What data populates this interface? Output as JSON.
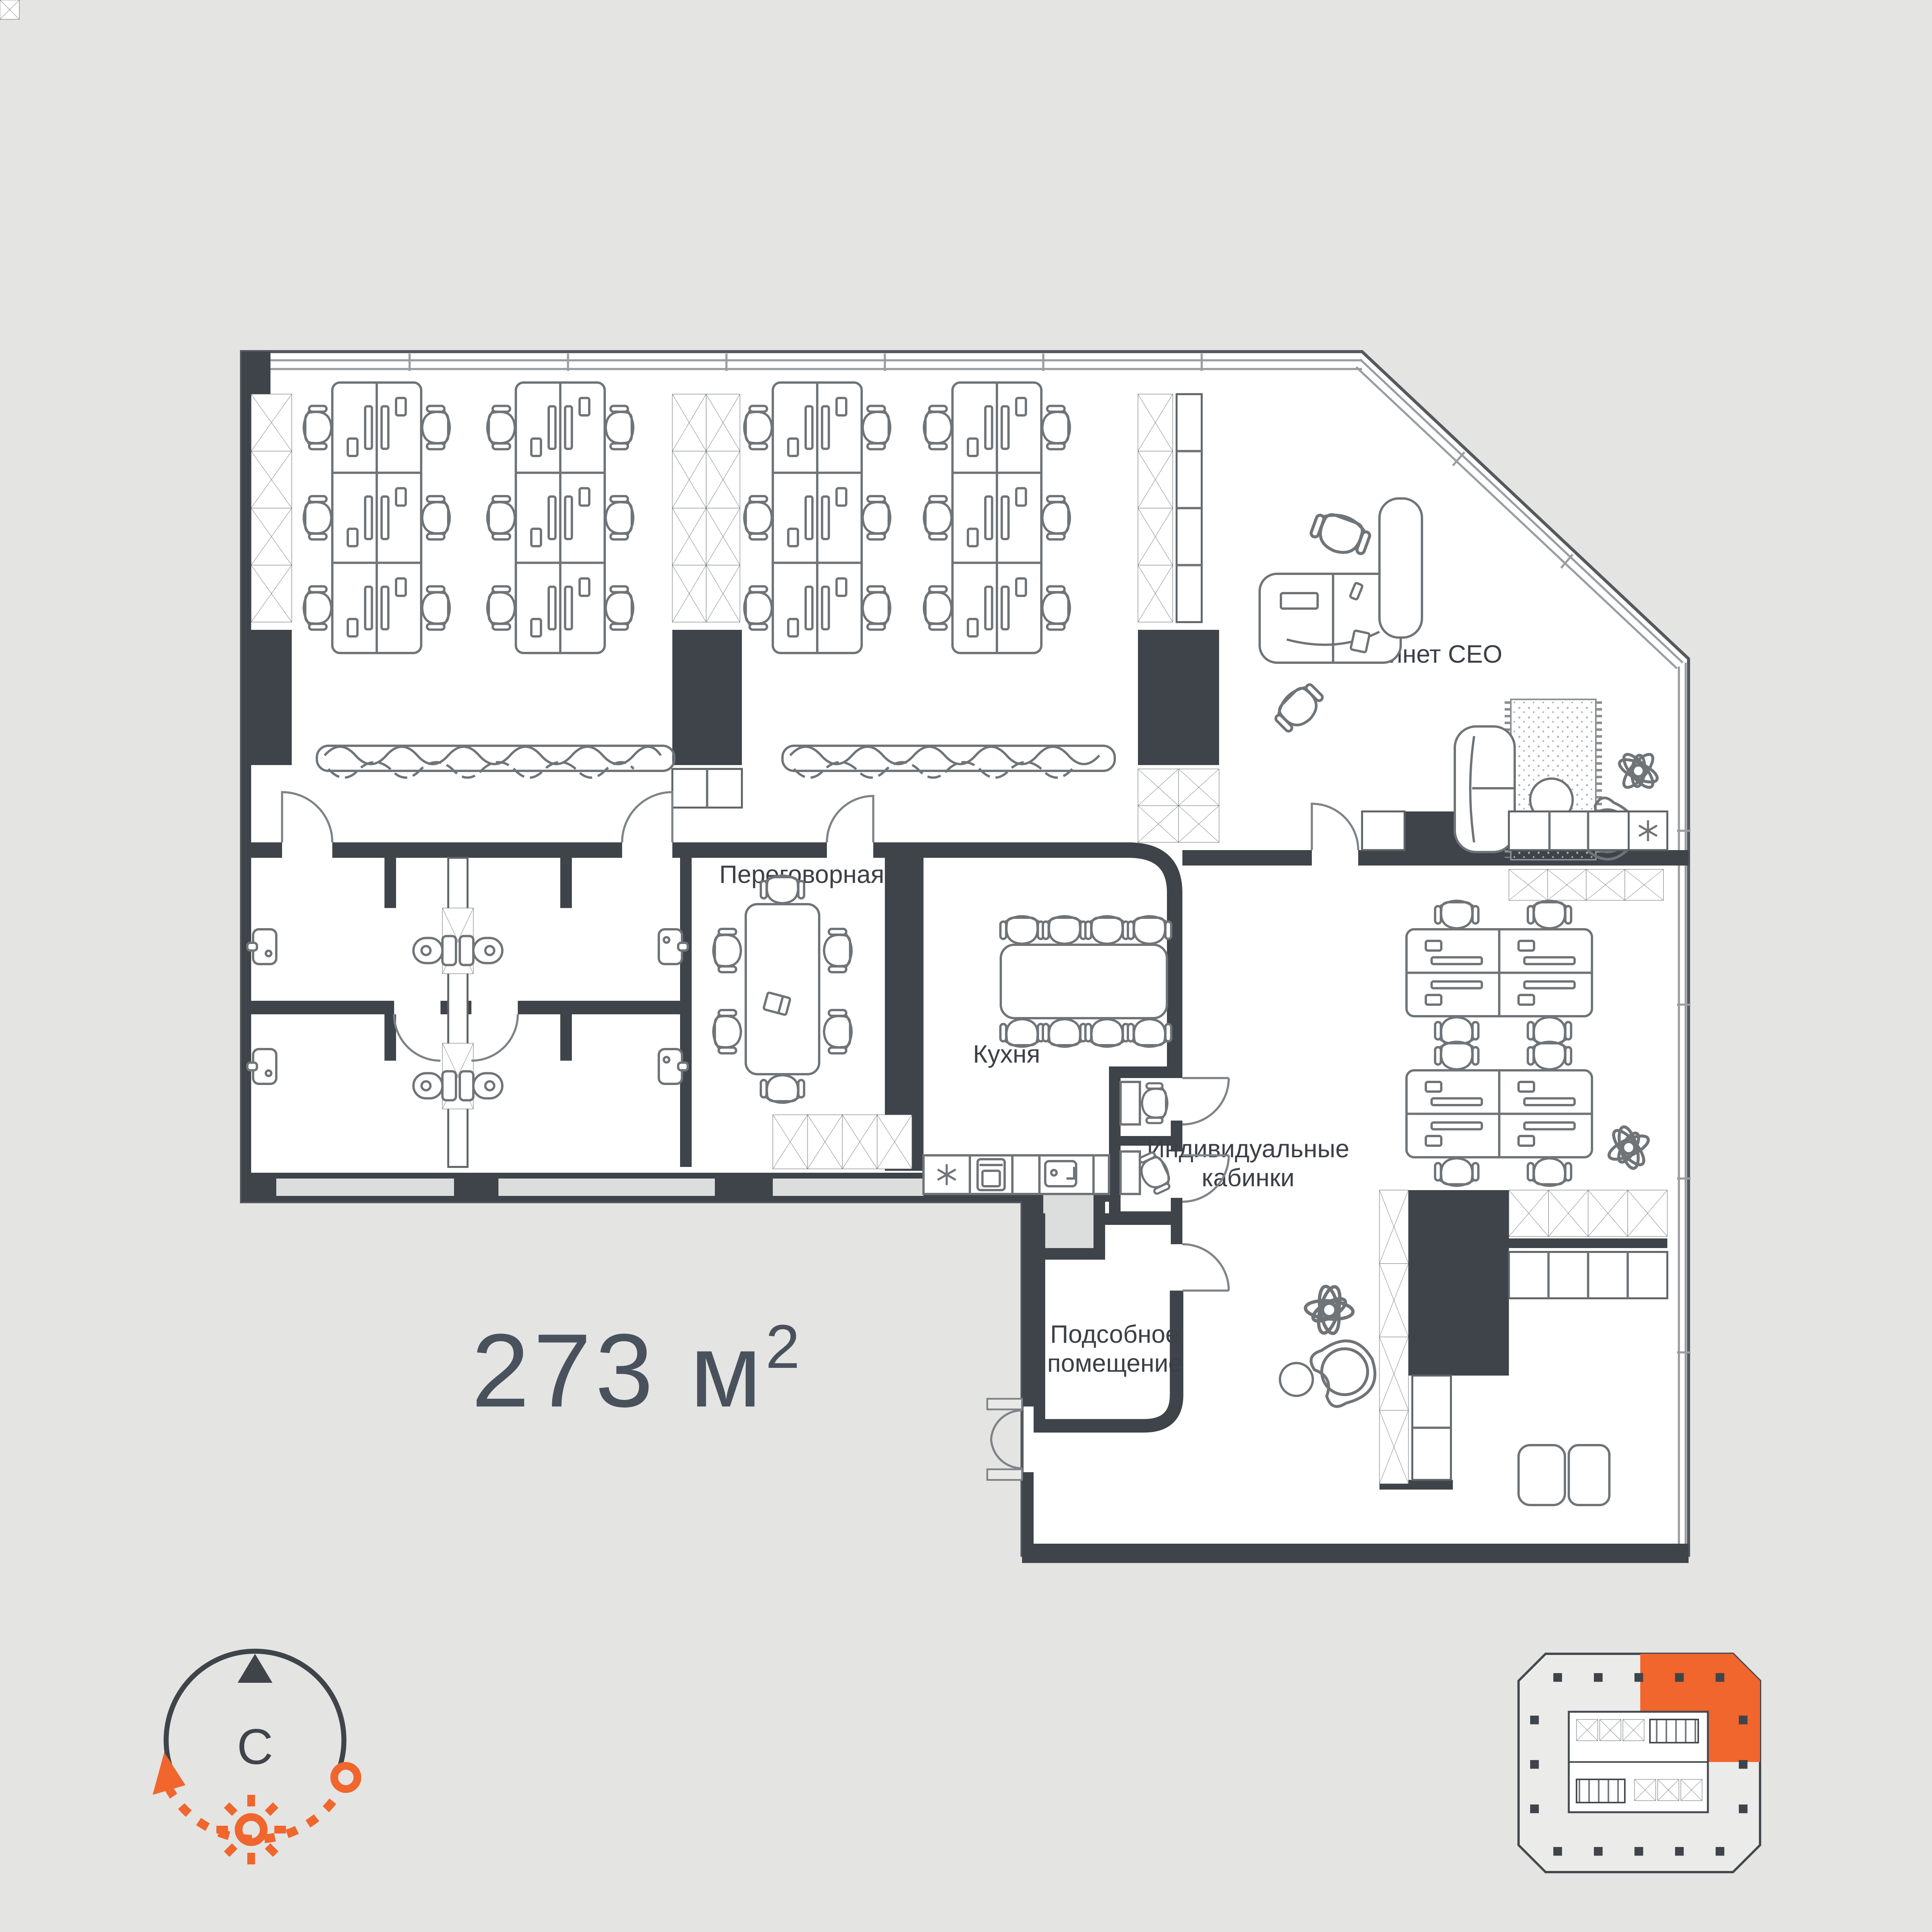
{
  "page": {
    "background": "#e4e4e3"
  },
  "floor_plan": {
    "area": {
      "value": "273",
      "unit_base": " м",
      "unit_sup": "2"
    },
    "room_labels": {
      "ceo_office": "Кабинет CEO",
      "meeting_room": "Переговорная",
      "kitchen": "Кухня",
      "individual_booths": [
        "Индивидуальные",
        "кабинки"
      ],
      "utility_room": [
        "Подсобное",
        "помещение"
      ]
    },
    "compass": {
      "north_label": "С"
    },
    "icons": {
      "snowflake": "fridge snowflake symbol",
      "sun": "sun path symbol",
      "north_arrow": "north triangle"
    },
    "colors": {
      "background": "#e4e4e3",
      "wall_dark": "#3f444a",
      "furniture_line": "#6f7478",
      "window_line": "#9a9ea1",
      "shaft_fill": "#dcdddd",
      "accent_orange": "#f0662d",
      "area_text": "#49525c",
      "label_text": "#3b4046"
    }
  }
}
